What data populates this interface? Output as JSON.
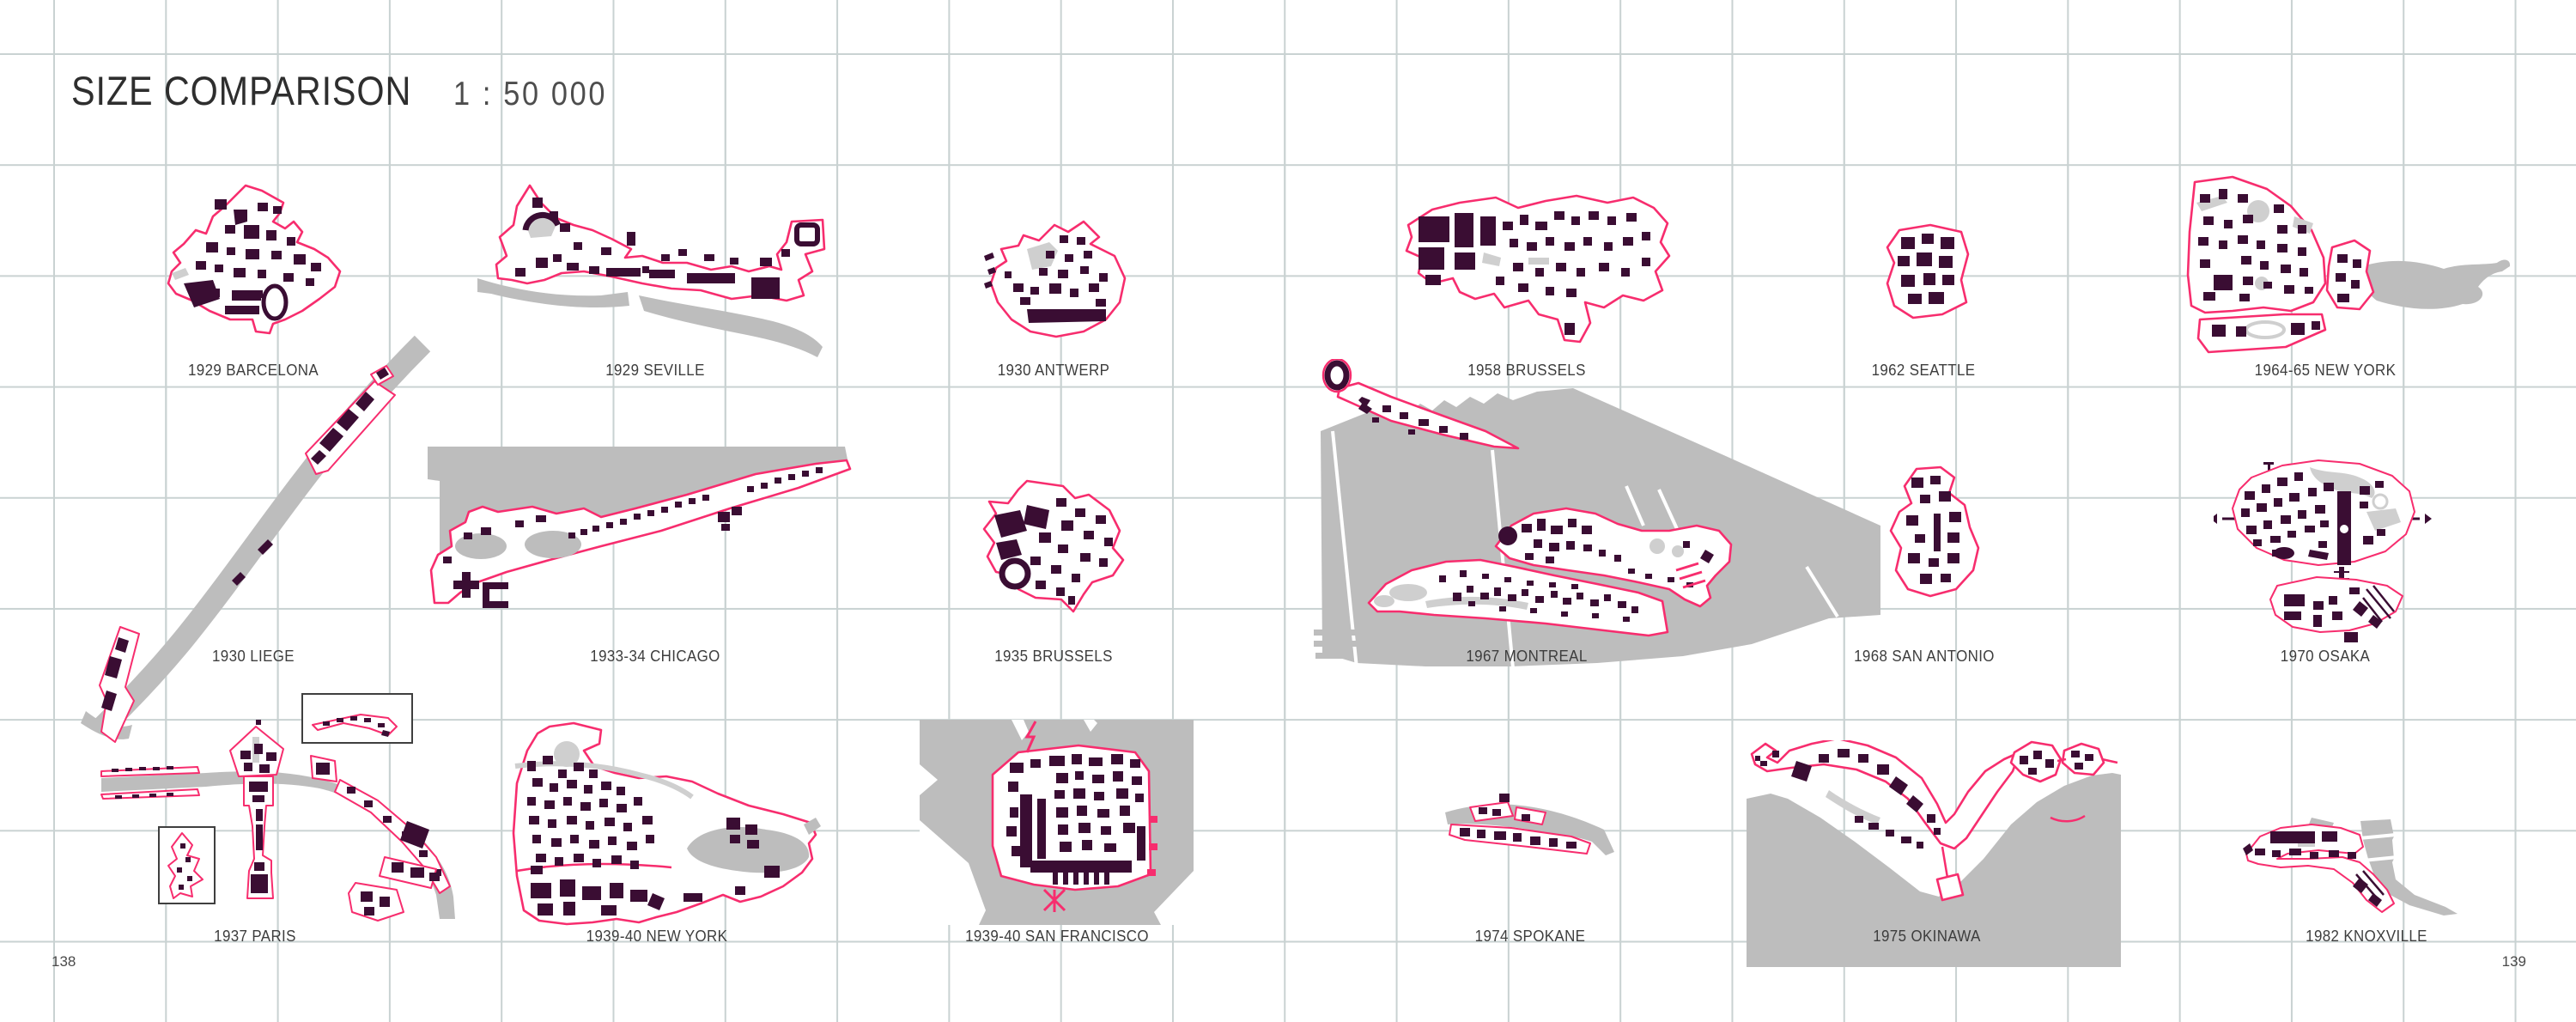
{
  "page": {
    "title": "SIZE COMPARISON",
    "scale_label": "1 : 50 000",
    "page_number_left": "138",
    "page_number_right": "139"
  },
  "maps": [
    {
      "id": "barcelona-1929",
      "label": "1929 BARCELONA"
    },
    {
      "id": "seville-1929",
      "label": "1929 SEVILLE"
    },
    {
      "id": "antwerp-1930",
      "label": "1930 ANTWERP"
    },
    {
      "id": "brussels-1958",
      "label": "1958 BRUSSELS"
    },
    {
      "id": "seattle-1962",
      "label": "1962 SEATTLE"
    },
    {
      "id": "newyork-1964",
      "label": "1964-65 NEW YORK"
    },
    {
      "id": "liege-1930",
      "label": "1930 LIEGE"
    },
    {
      "id": "chicago-1933",
      "label": "1933-34 CHICAGO"
    },
    {
      "id": "brussels-1935",
      "label": "1935 BRUSSELS"
    },
    {
      "id": "montreal-1967",
      "label": "1967 MONTREAL"
    },
    {
      "id": "sanantonio-1968",
      "label": "1968 SAN ANTONIO"
    },
    {
      "id": "osaka-1970",
      "label": "1970 OSAKA"
    },
    {
      "id": "paris-1937",
      "label": "1937 PARIS"
    },
    {
      "id": "newyork-1939",
      "label": "1939-40 NEW YORK"
    },
    {
      "id": "sanfrancisco-1939",
      "label": "1939-40 SAN FRANCISCO"
    },
    {
      "id": "spokane-1974",
      "label": "1974 SPOKANE"
    },
    {
      "id": "okinawa-1975",
      "label": "1975 OKINAWA"
    },
    {
      "id": "knoxville-1982",
      "label": "1982 KNOXVILLE"
    }
  ],
  "colors": {
    "site_outline": "#f72d6e",
    "building": "#3a0d33",
    "context_gray": "#bdbdbd",
    "grid": "#c9d2d2"
  }
}
